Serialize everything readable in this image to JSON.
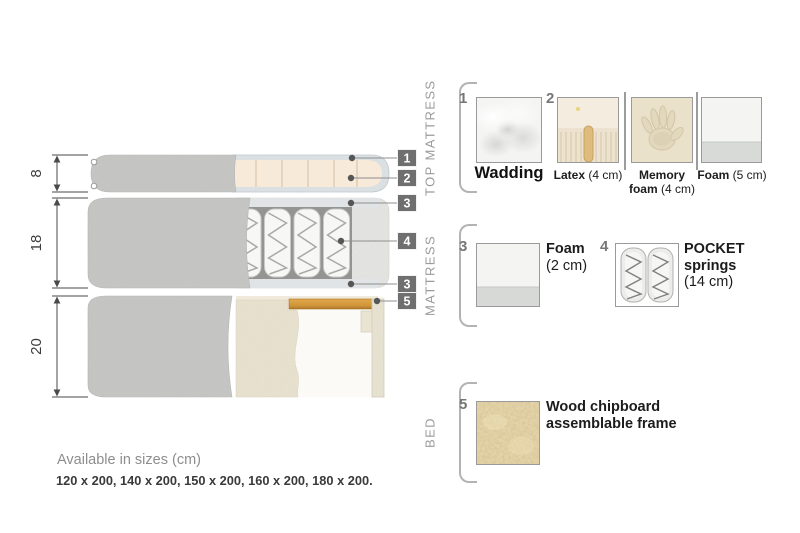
{
  "diagram": {
    "dims": [
      "8",
      "18",
      "20"
    ],
    "callouts": [
      "1",
      "2",
      "3",
      "4",
      "3",
      "5"
    ]
  },
  "legend": {
    "sections": [
      {
        "title": "TOP MATTRESS"
      },
      {
        "title": "MATTRESS"
      },
      {
        "title": "BED"
      }
    ],
    "items": {
      "wadding": {
        "num": "1",
        "name": "Wadding"
      },
      "latex": {
        "num": "2",
        "name": "Latex",
        "size": "(4 cm)"
      },
      "memory_foam": {
        "name_l1": "Memory",
        "name_l2": "foam",
        "size": "(4 cm)"
      },
      "foam_5": {
        "name": "Foam",
        "size": "(5 cm)"
      },
      "foam_2": {
        "num": "3",
        "name": "Foam",
        "size": "(2 cm)"
      },
      "pocket_springs": {
        "num": "4",
        "name_l1": "POCKET",
        "name_l2": "springs",
        "size": "(14 cm)"
      },
      "wood_frame": {
        "num": "5",
        "name_l1": "Wood chipboard",
        "name_l2": "assemblable frame"
      }
    }
  },
  "footer": {
    "sizes_title": "Available in sizes (cm)",
    "sizes_list": "120 x 200, 140 x 200, 150 x 200, 160 x 200, 180 x 200."
  },
  "colors": {
    "badge_gray": "#6f6f6f",
    "fabric_gray": "#c8c8c6",
    "foam_cream": "#f8ead9",
    "wadding_blue_gray": "#e0e6e9",
    "bed_cream": "#ece6d2",
    "wood_slat": "#d89b3f"
  }
}
